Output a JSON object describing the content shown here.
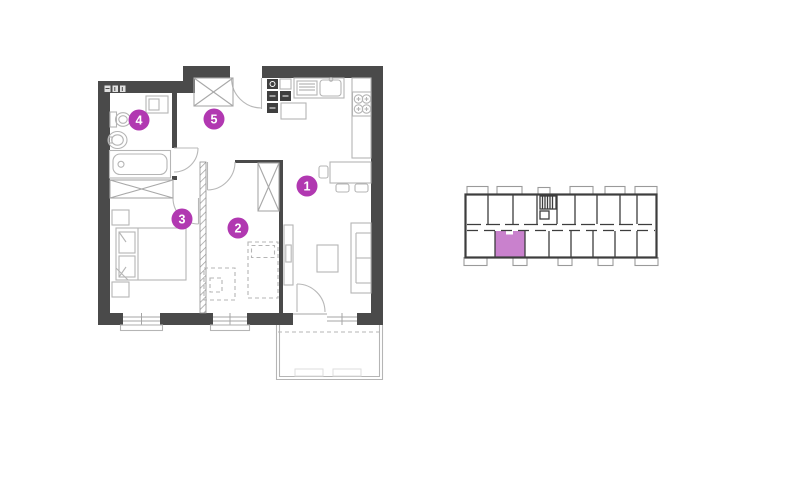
{
  "page": {
    "background": "#ffffff",
    "type": "apartment-floor-plan"
  },
  "colors": {
    "accent": "#b138b1",
    "unit_highlight": "#c981cd",
    "wall": "#4a4a4a",
    "furniture_line": "#b5b5b5",
    "overview_line": "#3d3d3d"
  },
  "floor_plan": {
    "room_markers": [
      {
        "number": "1"
      },
      {
        "number": "2"
      },
      {
        "number": "3"
      },
      {
        "number": "4"
      },
      {
        "number": "5"
      }
    ],
    "fixture_icons": [
      "entrance-door-icon",
      "wardrobe-icon",
      "washer-icon",
      "toilet-icon",
      "sink-icon",
      "bathtub-icon",
      "closet-icon",
      "electrical-panel-icon",
      "kitchen-sink-icon",
      "fridge-icon",
      "stove-icon",
      "dining-table-icon",
      "sofa-icon",
      "coffee-table-icon",
      "tv-unit-icon",
      "double-bed-icon",
      "nightstand-icon",
      "planned-bed-icon",
      "planned-desk-icon",
      "window-icon",
      "balcony-icon"
    ]
  },
  "building_overview": {
    "highlighted_unit": "bottom-row-unit-2",
    "rows": [
      "top",
      "bottom"
    ],
    "features": [
      "stairwell",
      "corridor",
      "balconies"
    ]
  }
}
